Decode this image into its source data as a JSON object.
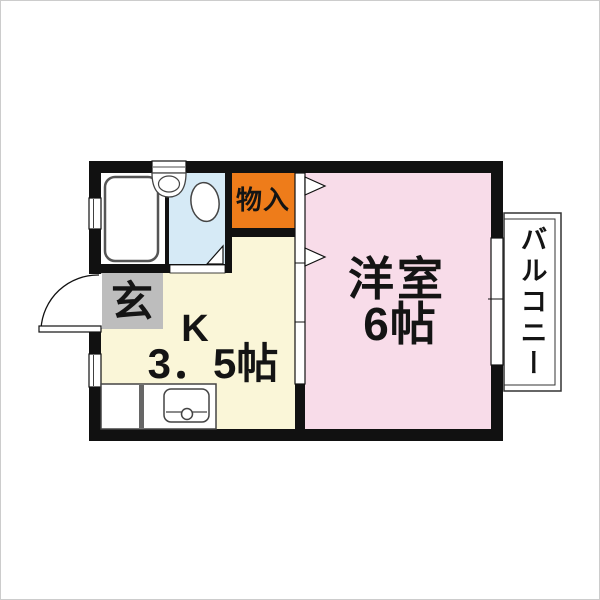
{
  "floorplan": {
    "rooms": {
      "western_room": {
        "name": "洋室",
        "size": "6帖",
        "color": "#f8dce9"
      },
      "kitchen": {
        "name": "K",
        "size": "3．5帖",
        "color": "#faf6d8"
      },
      "entrance": {
        "name": "玄",
        "color": "#bdbdbd"
      },
      "closet": {
        "name": "物入",
        "color": "#ee7c1a"
      },
      "balcony": {
        "name": "バルコニー",
        "color": "#ffffff"
      },
      "bathroom": {
        "color": "#d6eaf6"
      }
    },
    "wall_color": "#111111"
  }
}
